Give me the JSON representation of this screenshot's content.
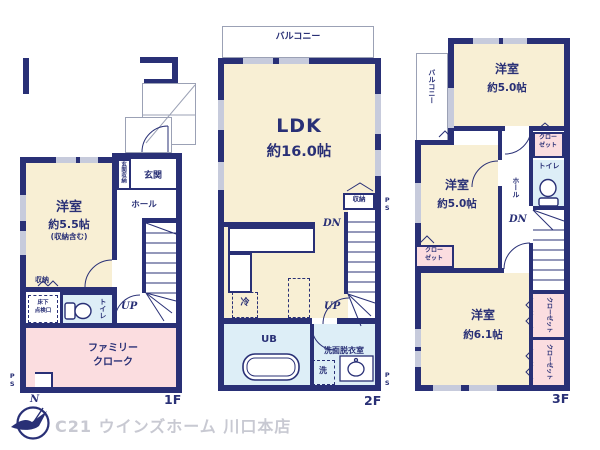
{
  "colors": {
    "wall": "#293076",
    "room_cream": "#f8efd4",
    "room_pink": "#fbdde0",
    "room_blue": "#ddeef7"
  },
  "footer": {
    "logo": "C21 ウインズホーム 川口本店",
    "north": "N"
  },
  "f1": {
    "label": "1F",
    "room_name": "洋室",
    "room_size": "約5.5帖",
    "room_note": "(収納含む)",
    "genkan_shunou": "玄関収納",
    "genkan": "玄関",
    "hall": "ホール",
    "up": "UP",
    "shunou": "収納",
    "yukashita1": "床下",
    "yukashita2": "点検口",
    "toilet": "トイレ",
    "family1": "ファミリー",
    "family2": "クローク",
    "ps": "PS"
  },
  "f2": {
    "label": "2F",
    "balcony": "バルコニー",
    "ldk_name": "LDK",
    "ldk_size": "約16.0帖",
    "shunou": "収納",
    "dn": "DN",
    "up": "UP",
    "rei": "冷",
    "ub": "UB",
    "senmen": "洗面脱衣室",
    "sen": "洗",
    "ps": "PS"
  },
  "f3": {
    "label": "3F",
    "balcony": "バルコニー",
    "room_a_name": "洋室",
    "room_a_size": "約5.0帖",
    "room_b_name": "洋室",
    "room_b_size": "約5.0帖",
    "room_c_name": "洋室",
    "room_c_size": "約6.1帖",
    "closet1": "クロー",
    "closet2": "ゼット",
    "closet_v": "クローゼット",
    "toilet": "トイレ",
    "hall": "ホール",
    "dn": "DN"
  }
}
